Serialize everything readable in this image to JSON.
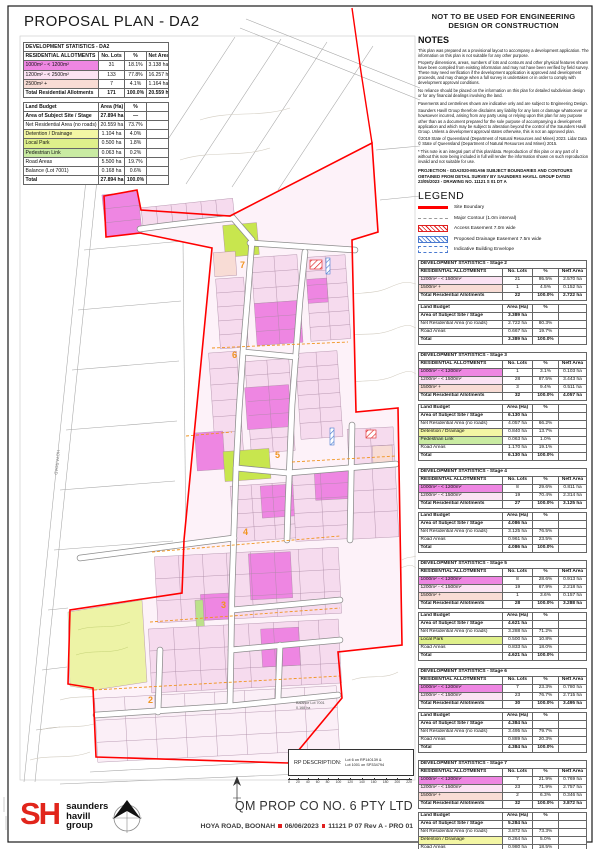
{
  "title": "PROPOSAL PLAN - DA2",
  "palette": {
    "magenta": "#ee86e2",
    "lightpink": "#fbe3f3",
    "rose": "#f8dcd5",
    "yellow": "#f3f6a4",
    "park": "#dff08b",
    "green": "#c9eba2",
    "boundary_red": "#ff0000",
    "stage_orange": "#f0941f",
    "easement_red": "#e02020",
    "easement_blue": "#4a7ad0",
    "park_bright": "#c8e64e",
    "detention_pale": "#edf3a6",
    "lot_pink": "#f6dbee",
    "lot_pale": "#fbeff7",
    "logo_red": "#e1251b"
  },
  "warning": "NOT TO BE USED FOR ENGINEERING DESIGN OR CONSTRUCTION",
  "notes": {
    "heading": "NOTES",
    "paragraphs": [
      "This plan was prepared as a provisional layout to accompany a development application. The information on this plan is not suitable for any other purpose.",
      "Property dimensions, areas, numbers of lots and contours and other physical features shown have been compiled from existing information and may not have been verified by field survey. These may need verification if the development application is approved and development proceeds, and may change when a full survey is undertaken or in order to comply with development approval conditions.",
      "No reliance should be placed on the information on this plan for detailed subdivision design or for any financial dealings involving the land.",
      "Pavements and centrelines shown are indicative only and are subject to Engineering Design.",
      "Saunders Havill Group therefore disclaims any liability for any loss or damage whatsoever or howsoever incurred, arising from any party using or relying upon this plan for any purpose other than as a document prepared for the sole purpose of accompanying a development application and which may be subject to alteration beyond the control of the Saunders Havill Group. Unless a development approval states otherwise, this is not an approved plan.",
      "©2019 State of Queensland (Department of Natural Resources and Mines) 2023. Lidar Data © State of Queensland (Department of Natural Resources and Mines) 2015.",
      "* This note is an integral part of this plan/data. Reproduction of this plan or any part of it without this note being included in full will render the information shown on such reproduction invalid and not suitable for use."
    ],
    "projection": "PROJECTION - GDA2020-MGA56 SUBJECT BOUNDARIES AND CONTOURS OBTAINED FROM DETAIL SURVEY BY SAUNDERS HAVILL GROUP DATED 23/05/2023 - DRAWING No. 11121 S 01 DT A"
  },
  "legend": {
    "heading": "LEGEND",
    "items": [
      {
        "type": "boundary",
        "label": "Site Boundary",
        "color": "#ff0000"
      },
      {
        "type": "contour",
        "label": "Major Contour (1.0m interval)",
        "color": "#9a9a9a"
      },
      {
        "type": "access",
        "label": "Access Easement 7.0m wide",
        "color": "#e02020"
      },
      {
        "type": "drainage",
        "label": "Proposed Drainage Easement 7.5m wide",
        "color": "#4a7ad0"
      },
      {
        "type": "envelope",
        "label": "Indicative Building Envelope",
        "color": "#4a7ad0"
      }
    ]
  },
  "da2": {
    "title": "DEVELOPMENT STATISTICS - DA2",
    "allotments": {
      "headers": [
        "RESIDENTIAL ALLOTMENTS",
        "No. Lots",
        "%",
        "Net Area"
      ],
      "rows": [
        {
          "label": "1000m² - < 1200m²",
          "color": "magenta",
          "lots": "31",
          "pct": "18.1%",
          "area": "3.138 ha"
        },
        {
          "label": "1200m² - < 2500m²",
          "color": "lightpink",
          "lots": "133",
          "pct": "77.8%",
          "area": "16.257 ha"
        },
        {
          "label": "2500m² +",
          "color": "rose",
          "lots": "7",
          "pct": "4.1%",
          "area": "1.164 ha"
        }
      ],
      "total": {
        "label": "Total Residential Allotments",
        "lots": "171",
        "pct": "100.0%",
        "area": "20.559 ha"
      }
    },
    "budget": {
      "headers": [
        "Land Budget",
        "Area (Ha)",
        "%"
      ],
      "rows": [
        {
          "label": "Area of Subject Site / Stage",
          "area": "27.894 ha",
          "pct": "—",
          "bold": true
        },
        {
          "label": "Net Residential Area (no roads)",
          "area": "20.559 ha",
          "pct": "73.7%"
        },
        {
          "label": "Detention / Drainage",
          "color": "yellow",
          "area": "1.104 ha",
          "pct": "4.0%"
        },
        {
          "label": "Local Park",
          "color": "park",
          "area": "0.500 ha",
          "pct": "1.8%"
        },
        {
          "label": "Pedestrian Link",
          "color": "green",
          "area": "0.063 ha",
          "pct": "0.2%"
        },
        {
          "label": "Road Areas",
          "area": "5.500 ha",
          "pct": "19.7%"
        },
        {
          "label": "Balance (Lot 7001)",
          "area": "0.168 ha",
          "pct": "0.6%"
        }
      ],
      "total": {
        "label": "Total",
        "area": "27.894 ha",
        "pct": "100.0%"
      }
    }
  },
  "stages": [
    {
      "title": "DEVELOPMENT STATISTICS - Stage 2",
      "allotments": {
        "headers": [
          "RESIDENTIAL ALLOTMENTS",
          "No. Lots",
          "%",
          "Nett Area"
        ],
        "rows": [
          {
            "label": "1200m² - < 1500m²",
            "color": "lightpink",
            "lots": "21",
            "pct": "95.5%",
            "area": "2.570 ha"
          },
          {
            "label": "1500m² +",
            "color": "rose",
            "lots": "1",
            "pct": "4.5%",
            "area": "0.152 ha"
          }
        ],
        "total": {
          "label": "Total Residential Allotments",
          "lots": "22",
          "pct": "100.0%",
          "area": "2.722 ha"
        }
      },
      "budget": {
        "headers": [
          "Land Budget",
          "Area (Ha)",
          "%"
        ],
        "rows": [
          {
            "label": "Area of Subject Site / Stage",
            "area": "3.389 ha",
            "pct": "",
            "bold": true
          },
          {
            "label": "Net Residential Area (no roads)",
            "area": "2.722 ha",
            "pct": "80.3%"
          },
          {
            "label": "Road Areas",
            "area": "0.667 ha",
            "pct": "19.7%"
          }
        ],
        "total": {
          "label": "Total",
          "area": "3.389 ha",
          "pct": "100.0%"
        }
      }
    },
    {
      "title": "DEVELOPMENT STATISTICS - Stage 3",
      "allotments": {
        "headers": [
          "RESIDENTIAL ALLOTMENTS",
          "No. Lots",
          "%",
          "Nett Area"
        ],
        "rows": [
          {
            "label": "1000m² - < 1200m²",
            "color": "magenta",
            "lots": "1",
            "pct": "3.1%",
            "area": "0.103 ha"
          },
          {
            "label": "1200m² - < 1500m²",
            "color": "lightpink",
            "lots": "28",
            "pct": "87.5%",
            "area": "3.443 ha"
          },
          {
            "label": "1500m² +",
            "color": "rose",
            "lots": "3",
            "pct": "9.4%",
            "area": "0.511 ha"
          }
        ],
        "total": {
          "label": "Total Residential Allotments",
          "lots": "32",
          "pct": "100.0%",
          "area": "4.057 ha"
        }
      },
      "budget": {
        "headers": [
          "Land Budget",
          "Area (Ha)",
          "%"
        ],
        "rows": [
          {
            "label": "Area of Subject Site / Stage",
            "area": "6.130 ha",
            "pct": "",
            "bold": true
          },
          {
            "label": "Net Residential Area (no roads)",
            "area": "4.057 ha",
            "pct": "66.2%"
          },
          {
            "label": "Detention / Drainage",
            "color": "yellow",
            "area": "0.840 ha",
            "pct": "13.7%"
          },
          {
            "label": "Pedestrian Link",
            "color": "green",
            "area": "0.063 ha",
            "pct": "1.0%"
          },
          {
            "label": "Road Areas",
            "area": "1.170 ha",
            "pct": "19.1%"
          }
        ],
        "total": {
          "label": "Total",
          "area": "6.130 ha",
          "pct": "100.0%"
        }
      }
    },
    {
      "title": "DEVELOPMENT STATISTICS - Stage 4",
      "allotments": {
        "headers": [
          "RESIDENTIAL ALLOTMENTS",
          "No. Lots",
          "%",
          "Nett Area"
        ],
        "rows": [
          {
            "label": "1000m² - < 1200m²",
            "color": "magenta",
            "lots": "8",
            "pct": "29.6%",
            "area": "0.811 ha"
          },
          {
            "label": "1200m² - < 1500m²",
            "color": "lightpink",
            "lots": "19",
            "pct": "70.4%",
            "area": "2.314 ha"
          }
        ],
        "total": {
          "label": "Total Residential Allotments",
          "lots": "27",
          "pct": "100.0%",
          "area": "3.125 ha"
        }
      },
      "budget": {
        "headers": [
          "Land Budget",
          "Area (Ha)",
          "%"
        ],
        "rows": [
          {
            "label": "Area of Subject Site / Stage",
            "area": "4.086 ha",
            "pct": "",
            "bold": true
          },
          {
            "label": "Net Residential Area (no roads)",
            "area": "3.125 ha",
            "pct": "76.5%"
          },
          {
            "label": "Road Areas",
            "area": "0.961 ha",
            "pct": "23.5%"
          }
        ],
        "total": {
          "label": "Total",
          "area": "4.086 ha",
          "pct": "100.0%"
        }
      }
    },
    {
      "title": "DEVELOPMENT STATISTICS - Stage 5",
      "allotments": {
        "headers": [
          "RESIDENTIAL ALLOTMENTS",
          "No. Lots",
          "%",
          "Nett Area"
        ],
        "rows": [
          {
            "label": "1000m² - < 1200m²",
            "color": "magenta",
            "lots": "8",
            "pct": "28.6%",
            "area": "0.913 ha"
          },
          {
            "label": "1200m² - < 1500m²",
            "color": "lightpink",
            "lots": "19",
            "pct": "67.9%",
            "area": "2.218 ha"
          },
          {
            "label": "1500m² +",
            "color": "rose",
            "lots": "1",
            "pct": "3.6%",
            "area": "0.157 ha"
          }
        ],
        "total": {
          "label": "Total Residential Allotments",
          "lots": "28",
          "pct": "100.0%",
          "area": "3.288 ha"
        }
      },
      "budget": {
        "headers": [
          "Land Budget",
          "Area (Ha)",
          "%"
        ],
        "rows": [
          {
            "label": "Area of Subject Site / Stage",
            "area": "4.621 ha",
            "pct": "",
            "bold": true
          },
          {
            "label": "Net Residential Area (no roads)",
            "area": "3.288 ha",
            "pct": "71.2%"
          },
          {
            "label": "Local Park",
            "color": "park",
            "area": "0.500 ha",
            "pct": "10.8%"
          },
          {
            "label": "Road Areas",
            "area": "0.833 ha",
            "pct": "18.0%"
          }
        ],
        "total": {
          "label": "Total",
          "area": "4.621 ha",
          "pct": "100.0%"
        }
      }
    },
    {
      "title": "DEVELOPMENT STATISTICS - Stage 6",
      "allotments": {
        "headers": [
          "RESIDENTIAL ALLOTMENTS",
          "No. Lots",
          "%",
          "Nett Area"
        ],
        "rows": [
          {
            "label": "1000m² - < 1200m²",
            "color": "magenta",
            "lots": "7",
            "pct": "23.3%",
            "area": "0.780 ha"
          },
          {
            "label": "1200m² - < 1500m²",
            "color": "lightpink",
            "lots": "23",
            "pct": "76.7%",
            "area": "2.715 ha"
          }
        ],
        "total": {
          "label": "Total Residential Allotments",
          "lots": "30",
          "pct": "100.0%",
          "area": "3.495 ha"
        }
      },
      "budget": {
        "headers": [
          "Land Budget",
          "Area (Ha)",
          "%"
        ],
        "rows": [
          {
            "label": "Area of Subject Site / Stage",
            "area": "4.384 ha",
            "pct": "",
            "bold": true
          },
          {
            "label": "Net Residential Area (no roads)",
            "area": "3.495 ha",
            "pct": "79.7%"
          },
          {
            "label": "Road Areas",
            "area": "0.889 ha",
            "pct": "20.3%"
          }
        ],
        "total": {
          "label": "Total",
          "area": "4.384 ha",
          "pct": "100.0%"
        }
      }
    },
    {
      "title": "DEVELOPMENT STATISTICS - Stage 7",
      "allotments": {
        "headers": [
          "RESIDENTIAL ALLOTMENTS",
          "No. Lots",
          "%",
          "Nett Area"
        ],
        "rows": [
          {
            "label": "1000m² - < 1200m²",
            "color": "magenta",
            "lots": "7",
            "pct": "21.9%",
            "area": "0.769 ha"
          },
          {
            "label": "1200m² - < 1500m²",
            "color": "lightpink",
            "lots": "23",
            "pct": "71.9%",
            "area": "2.757 ha"
          },
          {
            "label": "1500m² +",
            "color": "rose",
            "lots": "2",
            "pct": "6.3%",
            "area": "0.346 ha"
          }
        ],
        "total": {
          "label": "Total Residential Allotments",
          "lots": "32",
          "pct": "100.0%",
          "area": "3.872 ha"
        }
      },
      "budget": {
        "headers": [
          "Land Budget",
          "Area (Ha)",
          "%"
        ],
        "rows": [
          {
            "label": "Area of Subject Site / Stage",
            "area": "5.284 ha",
            "pct": "",
            "bold": true
          },
          {
            "label": "Net Residential Area (no roads)",
            "area": "3.872 ha",
            "pct": "73.3%"
          },
          {
            "label": "Detention / Drainage",
            "color": "yellow",
            "area": "0.264 ha",
            "pct": "5.0%"
          },
          {
            "label": "Road Areas",
            "area": "0.980 ha",
            "pct": "18.5%"
          },
          {
            "label": "Balance (Lot 7001)",
            "area": "0.168 ha",
            "pct": "3.2%"
          }
        ],
        "total": {
          "label": "Total",
          "area": "5.284 ha",
          "pct": "100.0%"
        }
      }
    }
  ],
  "plan": {
    "stage_labels": {
      "s2": "2",
      "s3": "3",
      "s4": "4",
      "s5": "5",
      "s6": "6",
      "s7": "7"
    },
    "road_label": "HOYA ROAD",
    "balance_line1": "Balance Lot 7001",
    "balance_line2": "0.168 ha"
  },
  "footer": {
    "rp_label": "RP DESCRIPTION:",
    "rp_line1": "Lot 6 on RP140139 &",
    "rp_line2": "Lot 1001 on SP334794",
    "scale_ticks": [
      "0",
      "20",
      "40",
      "60",
      "80",
      "100",
      "120",
      "140",
      "160",
      "180",
      "200",
      "220"
    ],
    "client": "QM PROP CO NO. 6 PTY LTD",
    "address": "HOYA ROAD, BOONAH",
    "date": "06/06/2023",
    "drawing": "11121 P 07 Rev A - PRO 01",
    "logo": {
      "mark": "SH",
      "line1": "saunders",
      "line2": "havill",
      "line3": "group"
    }
  }
}
